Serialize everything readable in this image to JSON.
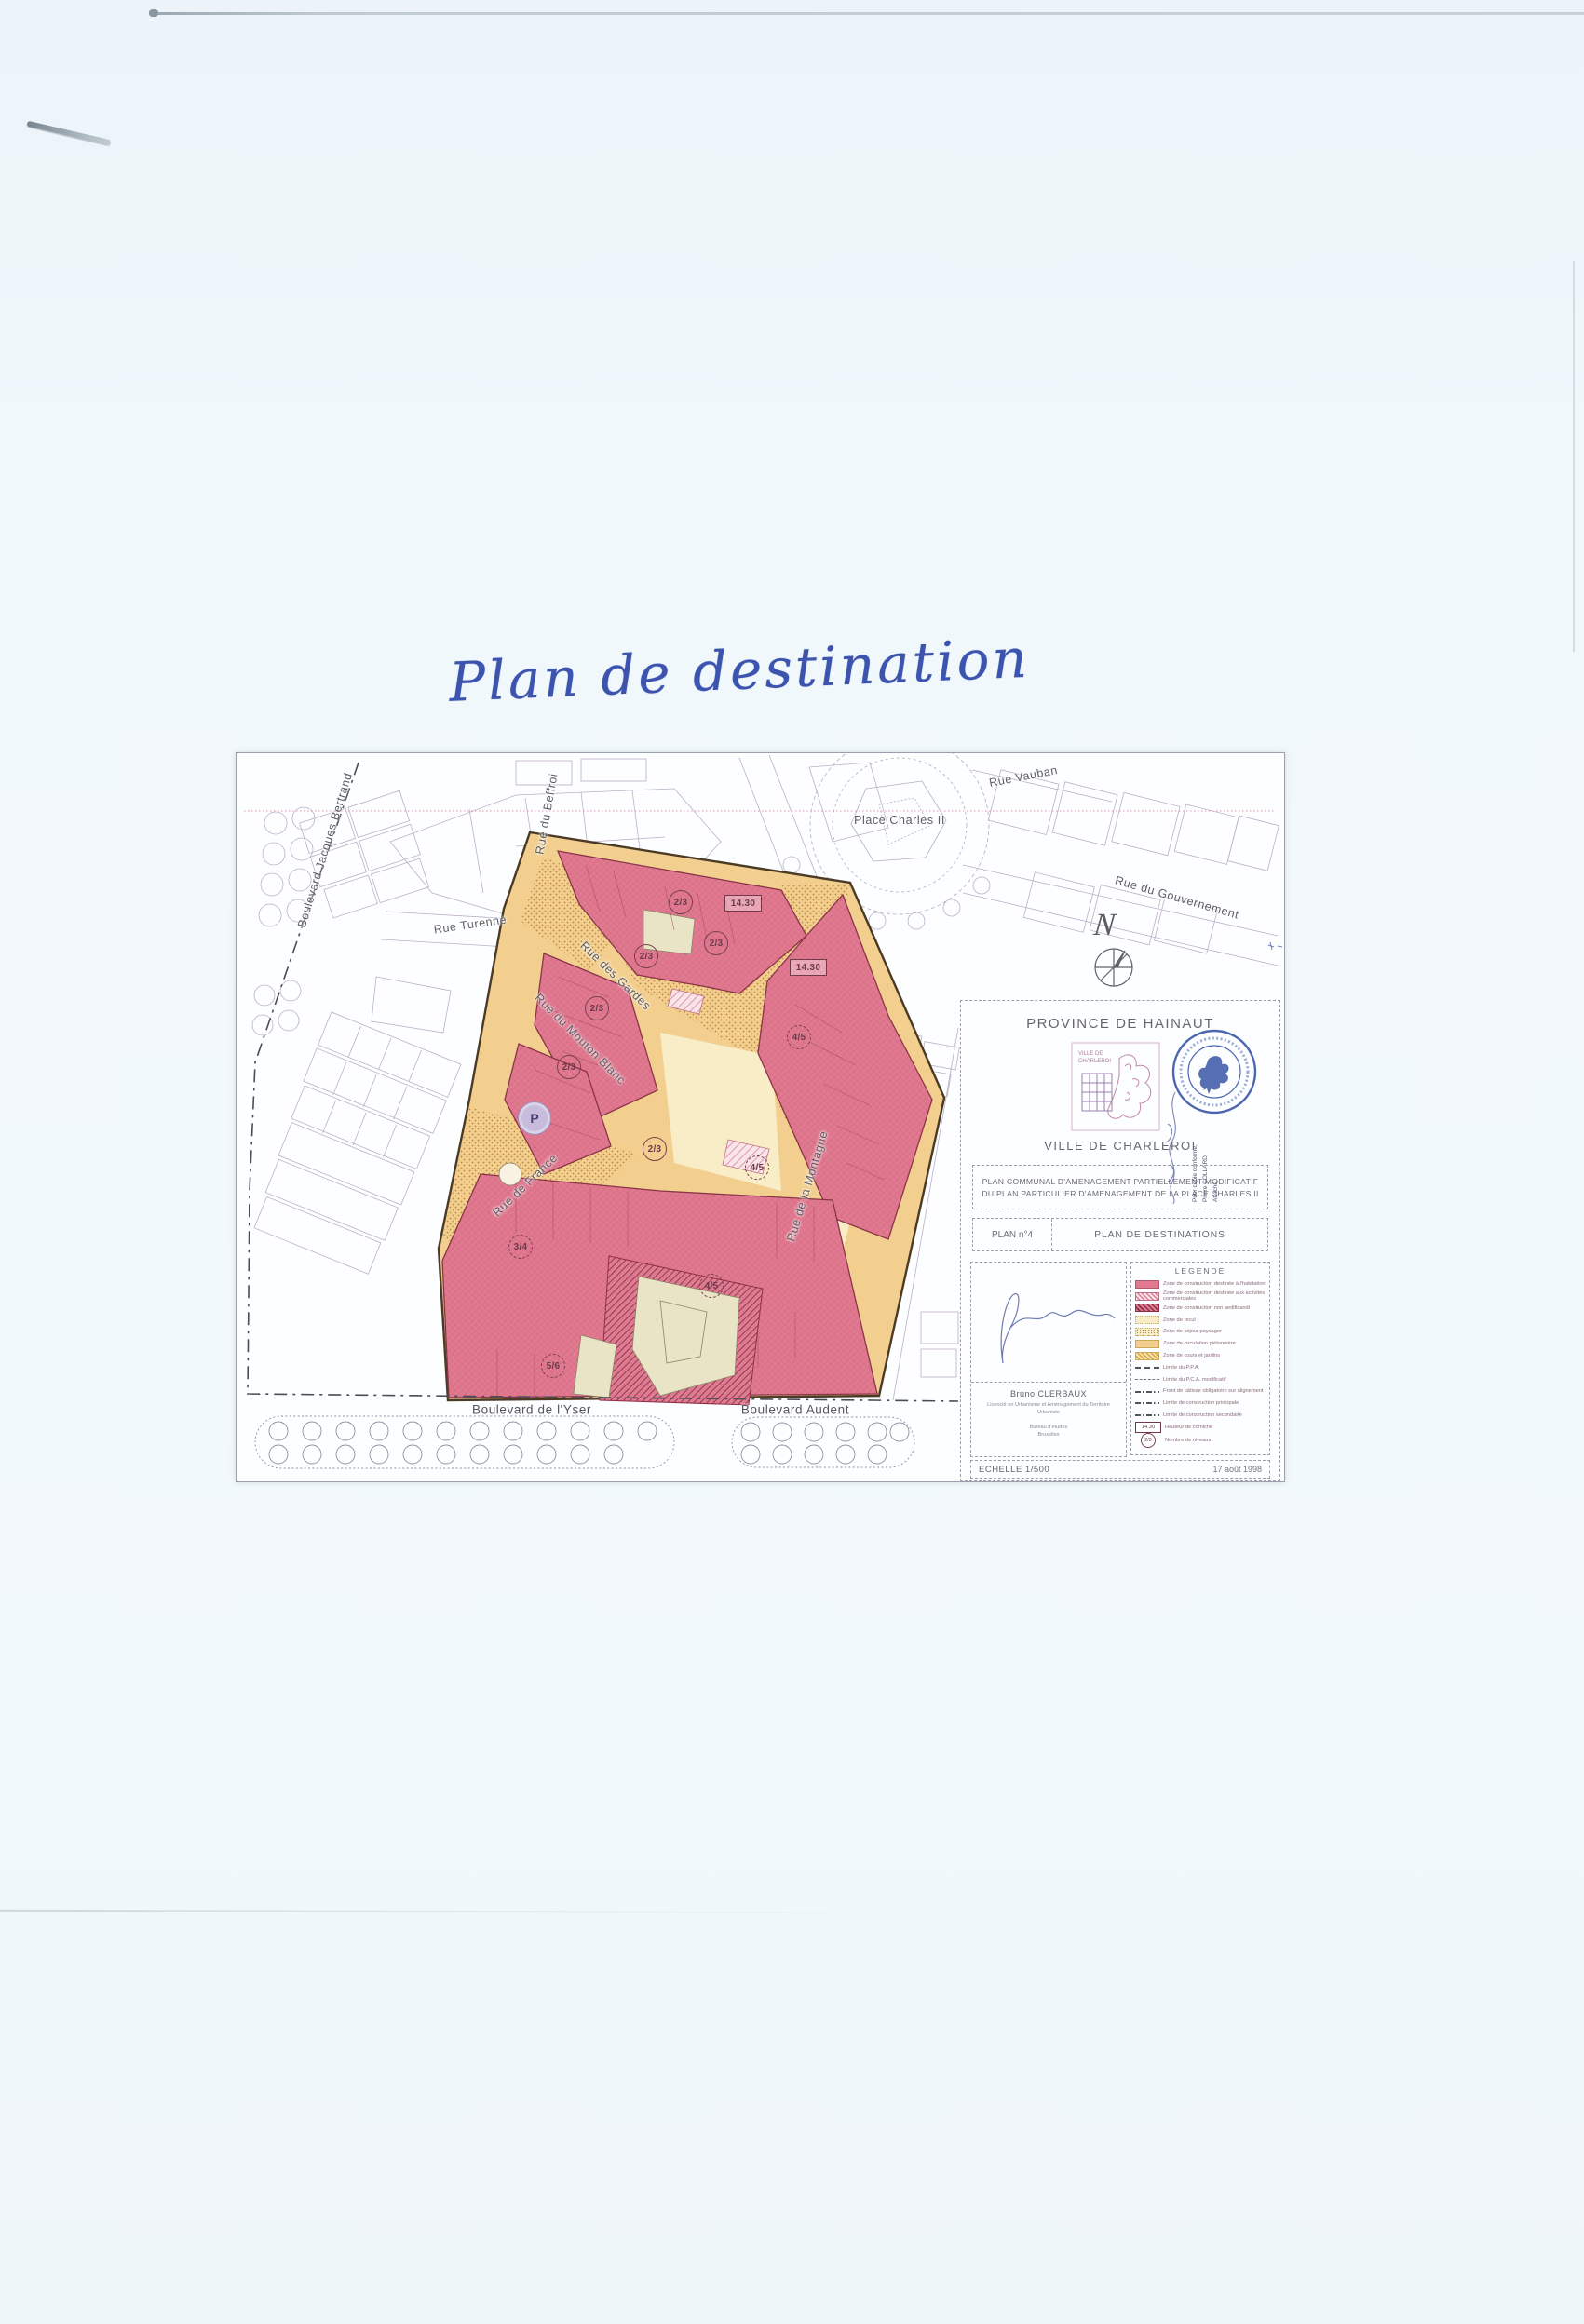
{
  "page": {
    "handwritten_title": "Plan de destination"
  },
  "map": {
    "streets": [
      {
        "id": "bd-jacques-bertrand",
        "label": "Boulevard Jacques Bertrand"
      },
      {
        "id": "rue-du-beffroi",
        "label": "Rue du Beffroi"
      },
      {
        "id": "rue-turenne",
        "label": "Rue Turenne"
      },
      {
        "id": "rue-vauban",
        "label": "Rue Vauban"
      },
      {
        "id": "place-charles-ii",
        "label": "Place Charles II"
      },
      {
        "id": "rue-du-gouvernement",
        "label": "Rue du Gouvernement"
      },
      {
        "id": "rue-des-gardes",
        "label": "Rue des Gardes"
      },
      {
        "id": "rue-du-mouton-blanc",
        "label": "Rue du Mouton Blanc"
      },
      {
        "id": "rue-de-france",
        "label": "Rue de France"
      },
      {
        "id": "rue-de-la-montagne",
        "label": "Rue de la Montagne"
      },
      {
        "id": "bd-yser",
        "label": "Boulevard de l'Yser"
      },
      {
        "id": "bd-audent",
        "label": "Boulevard Audent"
      }
    ],
    "north_label": "N",
    "parking_label": "P",
    "zone_labels": [
      {
        "text": "2/3",
        "shape": "circle"
      },
      {
        "text": "14.30",
        "shape": "box"
      },
      {
        "text": "2/3",
        "shape": "circle"
      },
      {
        "text": "2/3",
        "shape": "circle"
      },
      {
        "text": "14.30",
        "shape": "box"
      },
      {
        "text": "2/3",
        "shape": "circle"
      },
      {
        "text": "4/5",
        "shape": "dashed-circle"
      },
      {
        "text": "2/3",
        "shape": "circle"
      },
      {
        "text": "2/3",
        "shape": "circle"
      },
      {
        "text": "4/5",
        "shape": "dashed-circle"
      },
      {
        "text": "3/4",
        "shape": "dashed-circle"
      },
      {
        "text": "4/5",
        "shape": "dashed-circle"
      },
      {
        "text": "5/6",
        "shape": "dashed-circle"
      }
    ]
  },
  "cartouche": {
    "province": "PROVINCE DE HAINAUT",
    "city": "VILLE DE CHARLEROI",
    "seal_label": "VILLE DE CHARLEROI",
    "stamp_note_lines": [
      "Pour copie conforme,",
      "Pierre COLLARD,",
      "Attaché."
    ],
    "title_line1": "PLAN COMMUNAL D'AMENAGEMENT PARTIELLEMENT MODIFICATIF",
    "title_line2": "DU PLAN PARTICULIER D'AMENAGEMENT DE LA PLACE CHARLES II",
    "plan_no_label": "PLAN n°4",
    "plan_name": "PLAN DE DESTINATIONS",
    "author": {
      "name": "Bruno CLERBAUX",
      "lines": [
        "Licencié en Urbanisme et Aménagement du Territoire",
        "Urbaniste",
        "Bureau d'études",
        "Bruxelles"
      ]
    },
    "legend": {
      "title": "LEGENDE",
      "items": [
        {
          "swatch": "pink-solid",
          "label": "Zone de construction destinée à l'habitation"
        },
        {
          "swatch": "pink-hatch-light",
          "label": "Zone de construction destinée aux activités commerciales"
        },
        {
          "swatch": "pink-hatch-dense",
          "label": "Zone de construction non aedificandi"
        },
        {
          "swatch": "pale-yellow",
          "label": "Zone de recul"
        },
        {
          "swatch": "pale-yellow-dot",
          "label": "Zone de séjour paysager"
        },
        {
          "swatch": "orange",
          "label": "Zone de circulation piétonnière"
        },
        {
          "swatch": "orange-hatch",
          "label": "Zone de cours et jardins"
        },
        {
          "swatch": "line-dash-bold",
          "label": "Limite du P.P.A."
        },
        {
          "swatch": "line-dash",
          "label": "Limite du P.C.A. modificatif"
        },
        {
          "swatch": "line-dashdot",
          "label": "Front de bâtisse obligatoire sur alignement"
        },
        {
          "swatch": "line-dashdot",
          "label": "Limite de construction principale"
        },
        {
          "swatch": "line-dashdot",
          "label": "Limite de construction secondaire"
        },
        {
          "swatch": "sym-hauteur",
          "symbol": "14.30",
          "label": "Hauteur de corniche"
        },
        {
          "swatch": "sym-niveaux",
          "symbol": "2/3",
          "label": "Nombre de niveaux"
        }
      ]
    },
    "scale_label": "ECHELLE 1/500",
    "date": "17 août 1998"
  },
  "colors": {
    "zone_pink": "#e17a90",
    "zone_sand": "#f2cf8e",
    "zone_pale_yellow": "#f8edc6",
    "zone_olive": "#e9e4c6",
    "parking_purple": "#c7bcdc",
    "stamp_blue": "#3a56a8",
    "ink_blue": "#3c54ae"
  }
}
